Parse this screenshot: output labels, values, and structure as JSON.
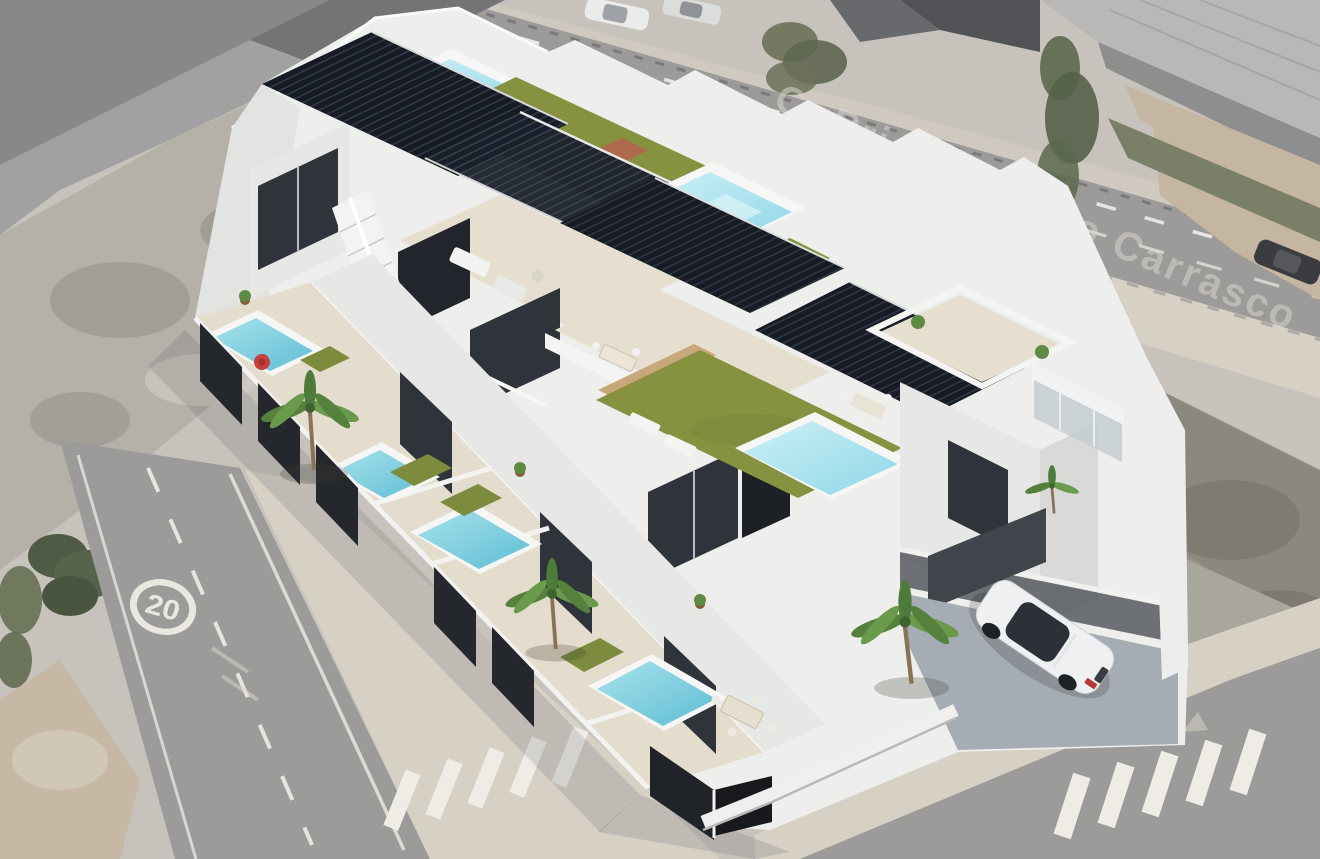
{
  "meta": {
    "type": "aerial-architectural-render",
    "description": "Full-color 3D render of a row of modern white townhouses with rooftop pools composited onto a grayscale aerial street photograph"
  },
  "watermark": {
    "street_label": "C. Prior Antonio Carrasco"
  },
  "road": {
    "speed_limit_marking": "20"
  },
  "scene": {
    "background_elements": [
      "asphalt roads with dashed lane lines",
      "zebra crosswalks",
      "beige sidewalks",
      "rubble lot",
      "warehouse roof",
      "parked cars",
      "palm trees",
      "dirt lots"
    ],
    "render_features": [
      "rooftop solarium pools",
      "black louvered pergolas",
      "artificial lawn roof terraces",
      "private garden pools",
      "dark slatted privacy fences",
      "exterior staircase",
      "palm trees",
      "carport with white car",
      "outdoor dining sets",
      "sun loungers",
      "red pool float"
    ]
  },
  "colors": {
    "white_walls": "#eeeeec",
    "wall_shadow": "#d9dad8",
    "pergola": "#171c24",
    "garden_pool_water": "#7fcfdf",
    "rooftop_pool_water": "#a9e0ec",
    "lawn": "#86923f",
    "terrace": "#e6dfd0",
    "fence": "#24272c",
    "asphalt": "#9c9b99",
    "sidewalk": "#d6d0c5",
    "dirt": "#c5b6a1",
    "palm": "#55813c",
    "car_body": "#eef0f1",
    "road_marking": "#eae7e0",
    "watermark": "#dcd8cf",
    "red_float": "#c4403a"
  }
}
